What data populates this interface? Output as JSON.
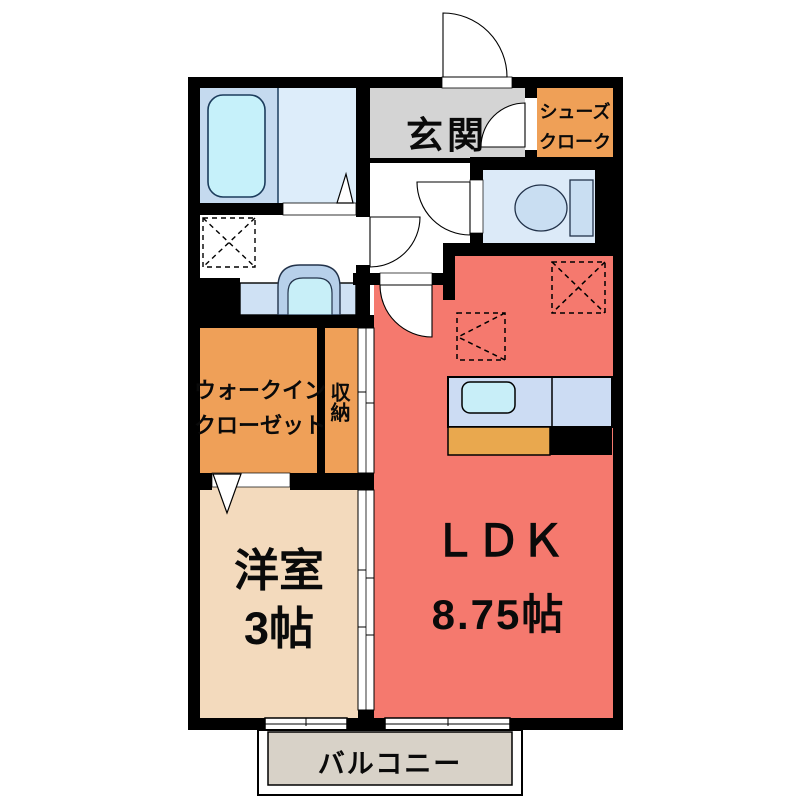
{
  "floor_plan": {
    "labels": {
      "genkan": "玄関",
      "shoes_cloak": {
        "line1": "シューズ",
        "line2": "クローク"
      },
      "walk_in_closet": {
        "line1": "ウォークイン",
        "line2": "クローゼット"
      },
      "storage": "収納",
      "western_room": {
        "name": "洋室",
        "size": "3帖"
      },
      "ldk": {
        "name": "ＬＤＫ",
        "size": "8.75帖"
      },
      "balcony": "バルコニー"
    },
    "colors": {
      "wall_black": "#000000",
      "ldk_red": "#f5796e",
      "western_room_beige": "#f3dabd",
      "closet_orange": "#efa058",
      "genkan_gray": "#d4d4d4",
      "balcony_gray": "#d8d2c8",
      "bath_blue_left": "#c5daef",
      "bath_blue_right": "#ddedfa",
      "toilet_floor_blue": "#dceaf8",
      "fixture_blue": "#c9def2",
      "bathtub_cyan": "#c6f1fa",
      "kitchen_counter_blue": "#ccdcf3",
      "kitchen_sink_cyan": "#c8eef8",
      "kitchen_cabinet_orange": "#e9a84e",
      "washstand_counter_blue": "#cfe1f4"
    }
  }
}
